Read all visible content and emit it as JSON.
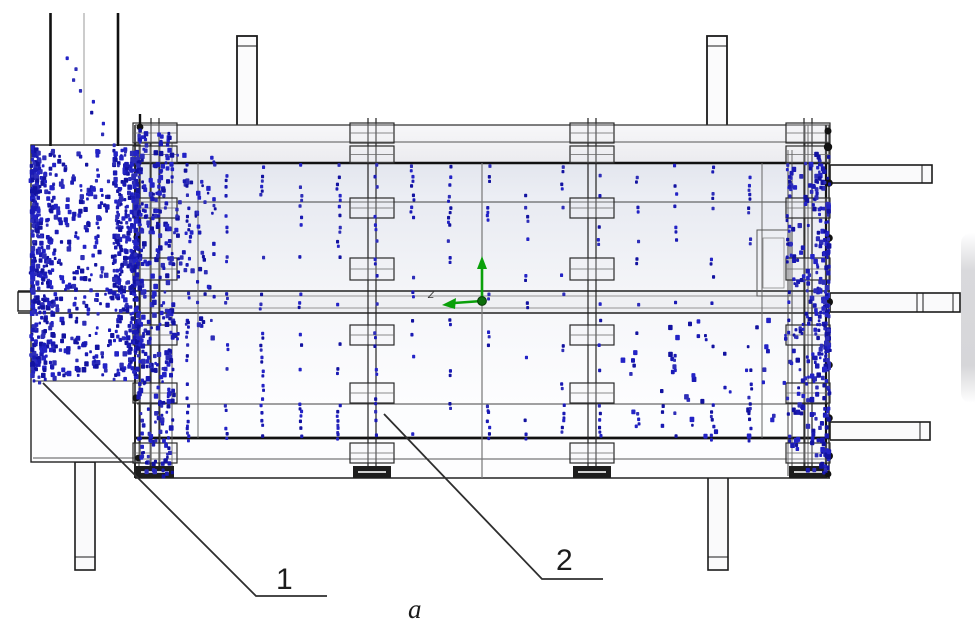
{
  "figure": {
    "callouts": [
      {
        "label": "1"
      },
      {
        "label": "2"
      }
    ],
    "caption": "a",
    "axis_label": "Z"
  },
  "colors": {
    "particle_shades": [
      "#1a1ab4",
      "#2323c6",
      "#2e2eb8",
      "#1212a0"
    ],
    "triad_green": "#0aa00a",
    "triad_origin": "#0b6e0b",
    "line_dark": "#1b1b1b",
    "leader": "#2e2e2e"
  },
  "structure": {
    "clamp_x": [
      155,
      372,
      592,
      808
    ],
    "plates": [
      [
        123,
        20
      ],
      [
        146,
        17
      ],
      [
        198,
        20
      ],
      [
        258,
        22
      ],
      [
        325,
        20
      ],
      [
        383,
        20
      ],
      [
        443,
        20
      ]
    ]
  },
  "particles": {
    "seed": 42,
    "regions": [
      {
        "id": "chute-trail",
        "x0": 66,
        "x1": 112,
        "y0": 58,
        "y1": 145,
        "count": 9,
        "mode": "trail"
      },
      {
        "id": "hopper-left",
        "x0": 32,
        "x1": 54,
        "y0": 146,
        "y1": 378,
        "count": 300,
        "bias": "left"
      },
      {
        "id": "hopper-mid",
        "x0": 54,
        "x1": 116,
        "y0": 150,
        "y1": 378,
        "count": 170
      },
      {
        "id": "hopper-right",
        "x0": 114,
        "x1": 138,
        "y0": 146,
        "y1": 380,
        "count": 260,
        "bias": "right"
      },
      {
        "id": "left-wall",
        "x0": 138,
        "x1": 174,
        "y0": 130,
        "y1": 474,
        "count": 240
      },
      {
        "id": "left-spill",
        "x0": 174,
        "x1": 215,
        "y0": 148,
        "y1": 340,
        "count": 55
      },
      {
        "id": "right-wall",
        "x0": 814,
        "x1": 829,
        "y0": 152,
        "y1": 474,
        "count": 170,
        "bias": "right"
      },
      {
        "id": "right-spill",
        "x0": 790,
        "x1": 814,
        "y0": 160,
        "y1": 470,
        "count": 70
      },
      {
        "id": "lower-right-scatter",
        "x0": 620,
        "x1": 800,
        "y0": 320,
        "y1": 436,
        "count": 40
      }
    ],
    "columns": {
      "x_start": 188,
      "x_step": 37.5,
      "x_count": 17,
      "pair_prob": 0.45,
      "bands": [
        {
          "y0": 166,
          "y1": 169,
          "step": 9,
          "prob": 0.6
        },
        {
          "y0": 176,
          "y1": 198,
          "step": 9.5,
          "prob": 0.72
        },
        {
          "y0": 207,
          "y1": 227,
          "step": 9.5,
          "prob": 0.58
        },
        {
          "y0": 240,
          "y1": 282,
          "step": 18,
          "prob": 0.45
        },
        {
          "y0": 293,
          "y1": 307,
          "step": 10,
          "prob": 0.55
        },
        {
          "y0": 321,
          "y1": 347,
          "step": 12,
          "prob": 0.4
        },
        {
          "y0": 356,
          "y1": 399,
          "step": 14,
          "prob": 0.33
        },
        {
          "y0": 405,
          "y1": 437,
          "step": 7.5,
          "prob": 0.68
        }
      ]
    }
  }
}
